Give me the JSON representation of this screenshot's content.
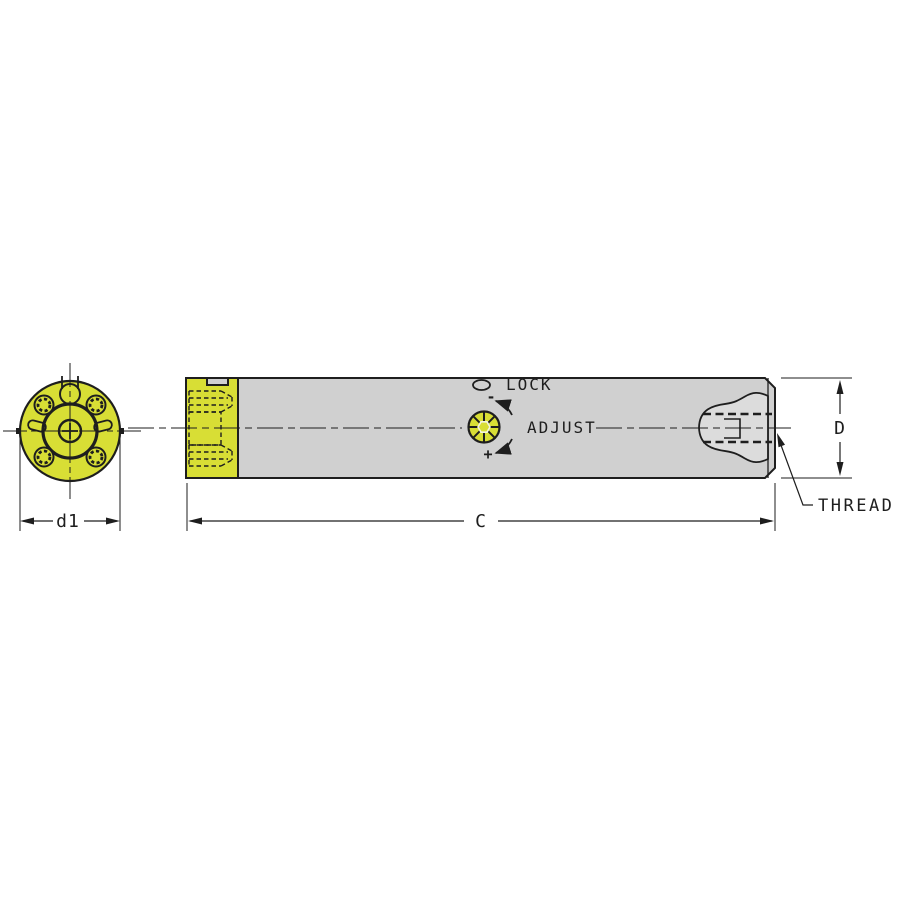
{
  "drawing": {
    "annotations": {
      "lock": "LOCK",
      "adjust": "ADJUST",
      "thread": "THREAD",
      "decrease": "-",
      "increase": "+"
    },
    "dimensions": {
      "overall_length": "C",
      "body_diameter": "D",
      "head_diameter": "d1"
    },
    "colors": {
      "highlight": "#d8de35",
      "body": "#d0d0d0",
      "pocket": "#dcdcdc",
      "line": "#1e1e1e",
      "background": "#ffffff"
    }
  }
}
